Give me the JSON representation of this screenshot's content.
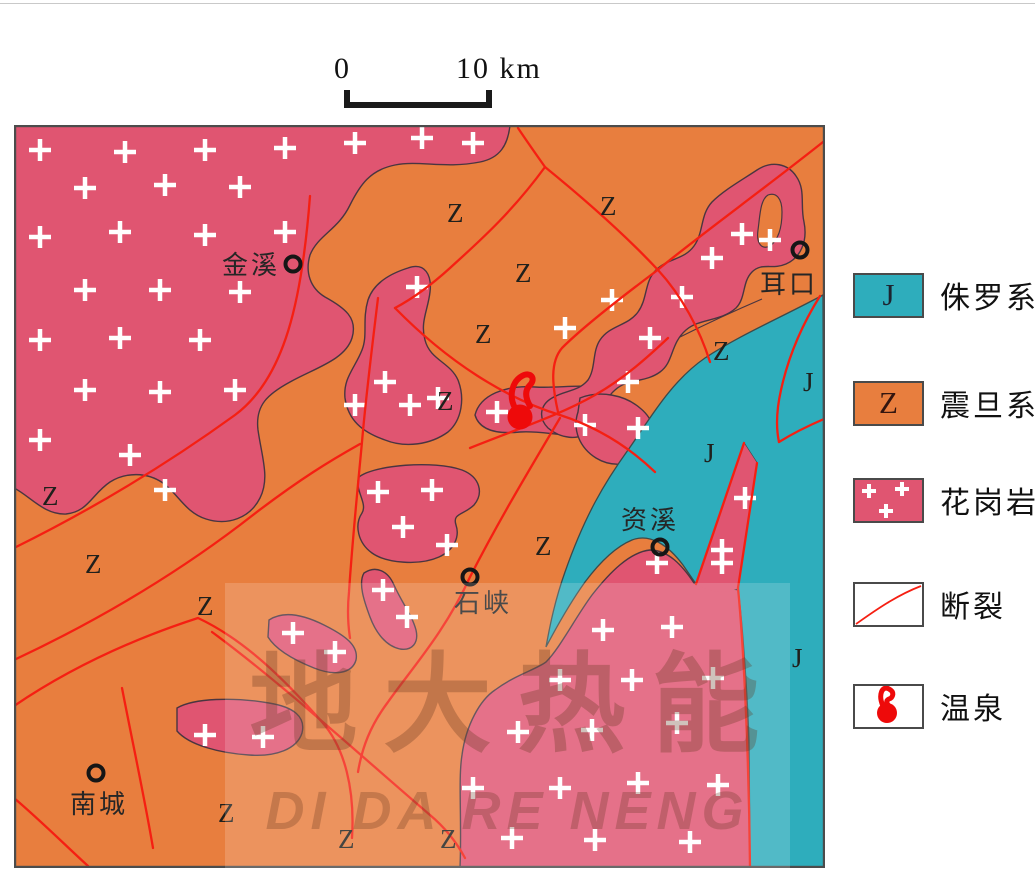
{
  "scale_bar": {
    "start_label": "0",
    "end_label": "10 km"
  },
  "legend": {
    "items": [
      {
        "id": "jurassic",
        "code": "J",
        "label": "侏罗系",
        "color": "#2eadbc"
      },
      {
        "id": "sinian",
        "code": "Z",
        "label": "震旦系",
        "color": "#e87e3e"
      },
      {
        "id": "granite",
        "code": "",
        "label": "花岗岩",
        "color": "#e05571"
      },
      {
        "id": "fault",
        "code": "",
        "label": "断裂",
        "color": "#f51f12"
      },
      {
        "id": "hot-spring",
        "code": "",
        "label": "温泉",
        "color": "#ee0a0a"
      }
    ]
  },
  "map": {
    "colors": {
      "granite": "#e05571",
      "sinian_orange": "#e87e3e",
      "jurassic_teal": "#2eadbc",
      "fault_red": "#f51f12",
      "border": "#4c4c4c"
    },
    "unit_labels": [
      {
        "text": "Z",
        "x": 28,
        "y": 380
      },
      {
        "text": "Z",
        "x": 71,
        "y": 448
      },
      {
        "text": "Z",
        "x": 183,
        "y": 490
      },
      {
        "text": "Z",
        "x": 433,
        "y": 97
      },
      {
        "text": "Z",
        "x": 586,
        "y": 90
      },
      {
        "text": "Z",
        "x": 501,
        "y": 157
      },
      {
        "text": "Z",
        "x": 461,
        "y": 218
      },
      {
        "text": "Z",
        "x": 423,
        "y": 285
      },
      {
        "text": "Z",
        "x": 521,
        "y": 430
      },
      {
        "text": "Z",
        "x": 699,
        "y": 235
      },
      {
        "text": "Z",
        "x": 204,
        "y": 697
      },
      {
        "text": "Z",
        "x": 324,
        "y": 723
      },
      {
        "text": "Z",
        "x": 426,
        "y": 723
      },
      {
        "text": "J",
        "x": 789,
        "y": 266
      },
      {
        "text": "J",
        "x": 690,
        "y": 337
      },
      {
        "text": "J",
        "x": 778,
        "y": 542
      }
    ],
    "towns": [
      {
        "name": "金溪",
        "cx": 279,
        "cy": 139,
        "lx": 266,
        "ly": 149,
        "anchor": "end"
      },
      {
        "name": "耳口",
        "cx": 786,
        "cy": 125,
        "lx": 775,
        "ly": 168,
        "anchor": "middle"
      },
      {
        "name": "资溪",
        "cx": 646,
        "cy": 422,
        "lx": 636,
        "ly": 404,
        "anchor": "middle"
      },
      {
        "name": "石峡",
        "cx": 456,
        "cy": 452,
        "lx": 469,
        "ly": 487,
        "anchor": "middle"
      },
      {
        "name": "南城",
        "cx": 82,
        "cy": 648,
        "lx": 85,
        "ly": 688,
        "anchor": "middle"
      }
    ],
    "hot_spring": {
      "x": 506,
      "y": 292
    }
  },
  "watermark": {
    "cn": "地大热能",
    "en": "DI DA RE NENG"
  }
}
